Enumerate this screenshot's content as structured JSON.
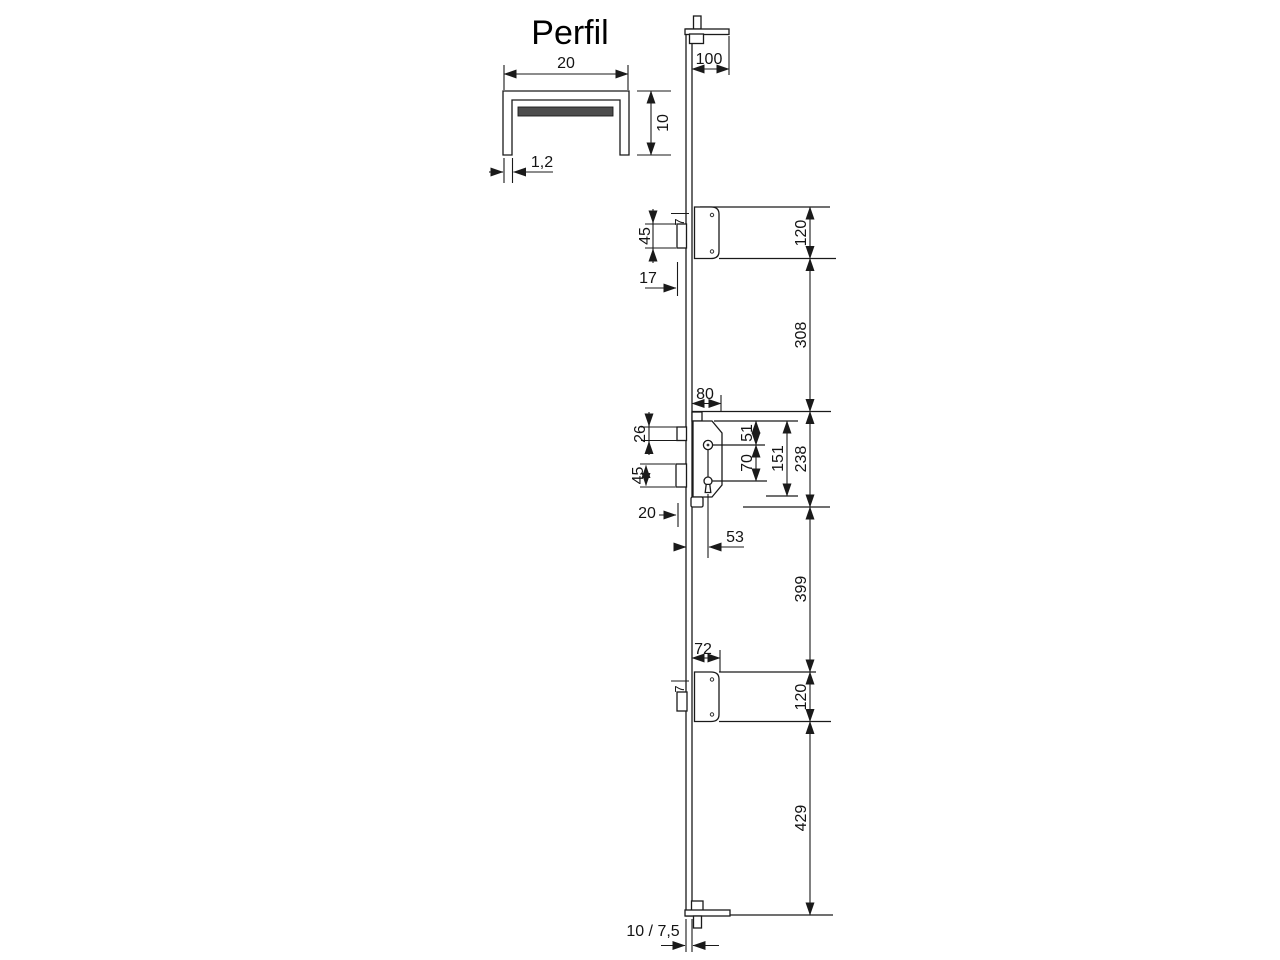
{
  "profile_detail": {
    "title": "Perfil",
    "width": "20",
    "height": "10",
    "wall_thickness": "1,2"
  },
  "top_bracket": {
    "width": "100"
  },
  "top_keeper": {
    "bolt_height": "45",
    "bolt_protrusion": "7",
    "offset": "17"
  },
  "lock_case": {
    "faceplate_width": "80",
    "latch_height": "26",
    "deadbolt_height": "45",
    "deadbolt_throw": "20",
    "backset": "53",
    "hub_offset": "51",
    "hub_to_cylinder": "70",
    "case_height": "151"
  },
  "bottom_keeper": {
    "offset": "72",
    "bolt_protrusion": "7"
  },
  "bottom": {
    "rail_thickness": "10 / 7,5"
  },
  "dim_chain": [
    "120",
    "308",
    "238",
    "399",
    "120",
    "429"
  ],
  "colors": {
    "line": "#1a1a1a",
    "profile_fill": "#c5c5c5",
    "insert_fill": "#4d4d4d",
    "background": "#ffffff"
  }
}
